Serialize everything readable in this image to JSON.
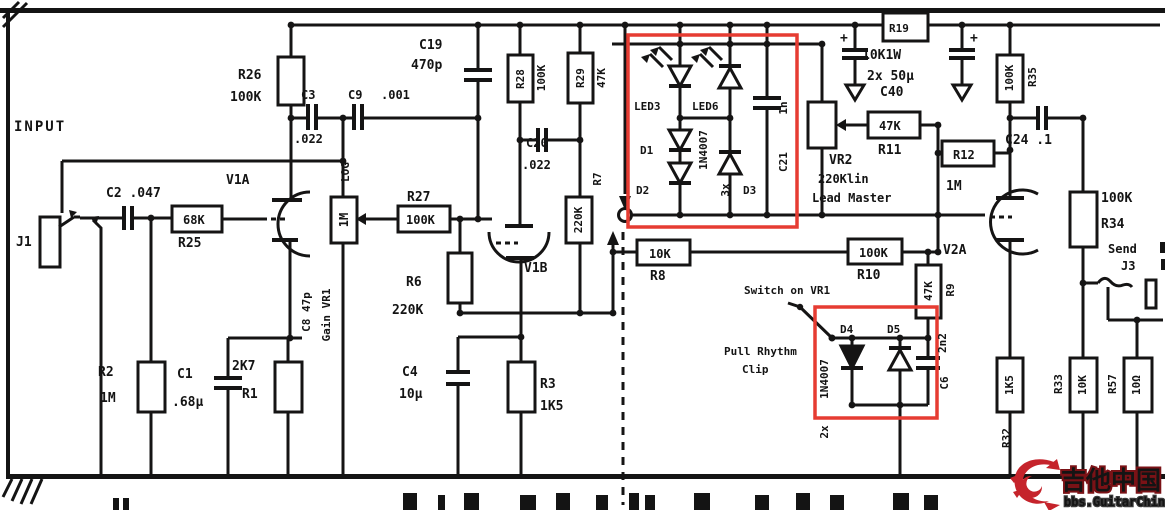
{
  "colors": {
    "line": "#151414",
    "red_box": "#e63c32",
    "logo_red": "#c5232b",
    "paper": "#ffffff"
  },
  "schematic": {
    "input": "INPUT",
    "j1": "J1",
    "c2": "C2 .047",
    "r25_val": "68K",
    "r25": "R25",
    "v1a": "V1A",
    "r26": "R26",
    "r26_val": "100K",
    "c3": "C3",
    "c3_val": ".022",
    "c9": "C9",
    "c9_val": ".001",
    "log": "LOG",
    "vr1_val": "1M",
    "c8": "C8 47p",
    "gain": "Gain VR1",
    "r2": "R2",
    "r2_val": "1M",
    "c1": "C1",
    "c1_val": ".68μ",
    "r1_val": "2K7",
    "r1": "R1",
    "r27": "R27",
    "r27_val": "100K",
    "r6": "R6",
    "r6_val": "220K",
    "v1b": "V1B",
    "c4": "C4",
    "c4_val": "10μ",
    "r3": "R3",
    "r3_val": "1K5",
    "c19": "C19",
    "c19_val": "470p",
    "r28": "R28",
    "r28_val": "100K",
    "r29": "R29",
    "r29_val": "47K",
    "c20": "C20",
    "c20_val": ".022",
    "r7": "R7",
    "r7_val": "220K",
    "led3": "LED3",
    "led6": "LED6",
    "d1": "D1",
    "d2": "D2",
    "d3": "D3",
    "diode_type1": "1N4007",
    "diode_qty1": "3x",
    "c21": "C21",
    "c21_val": "1n",
    "r8": "R8",
    "r8_val": "10K",
    "r19": "R19",
    "r19_val": "10K1W",
    "c40_qty": "2x 50μ",
    "c40": "C40",
    "plus": "+",
    "vr2": "VR2",
    "vr2_val": "220Klin",
    "vr2_fn": "Lead Master",
    "r11": "R11",
    "r11_val": "47K",
    "r12": "R12",
    "r12_val": "1M",
    "r10": "R10",
    "r10_val": "100K",
    "r9": "R9",
    "r9_val": "47K",
    "switch_lbl": "Switch on VR1",
    "pull1": "Pull Rhythm",
    "pull2": "Clip",
    "d4": "D4",
    "d5": "D5",
    "diode_type2": "1N4007",
    "diode_qty2": "2x",
    "c6": "C6",
    "c6_val": "2n2",
    "v2a": "V2A",
    "r35": "R35",
    "r35_val": "100K",
    "c24": "C24 .1",
    "r34": "R34",
    "r34_val": "100K",
    "r32": "R32",
    "r32_val": "1K5",
    "r33": "R33",
    "r33_val": "10K",
    "r57": "R57",
    "r57_val": "10Ω",
    "send": "Send",
    "j3": "J3"
  },
  "watermark": {
    "cn": "吉他中国",
    "url": "bbs.GuitarChina.com"
  }
}
